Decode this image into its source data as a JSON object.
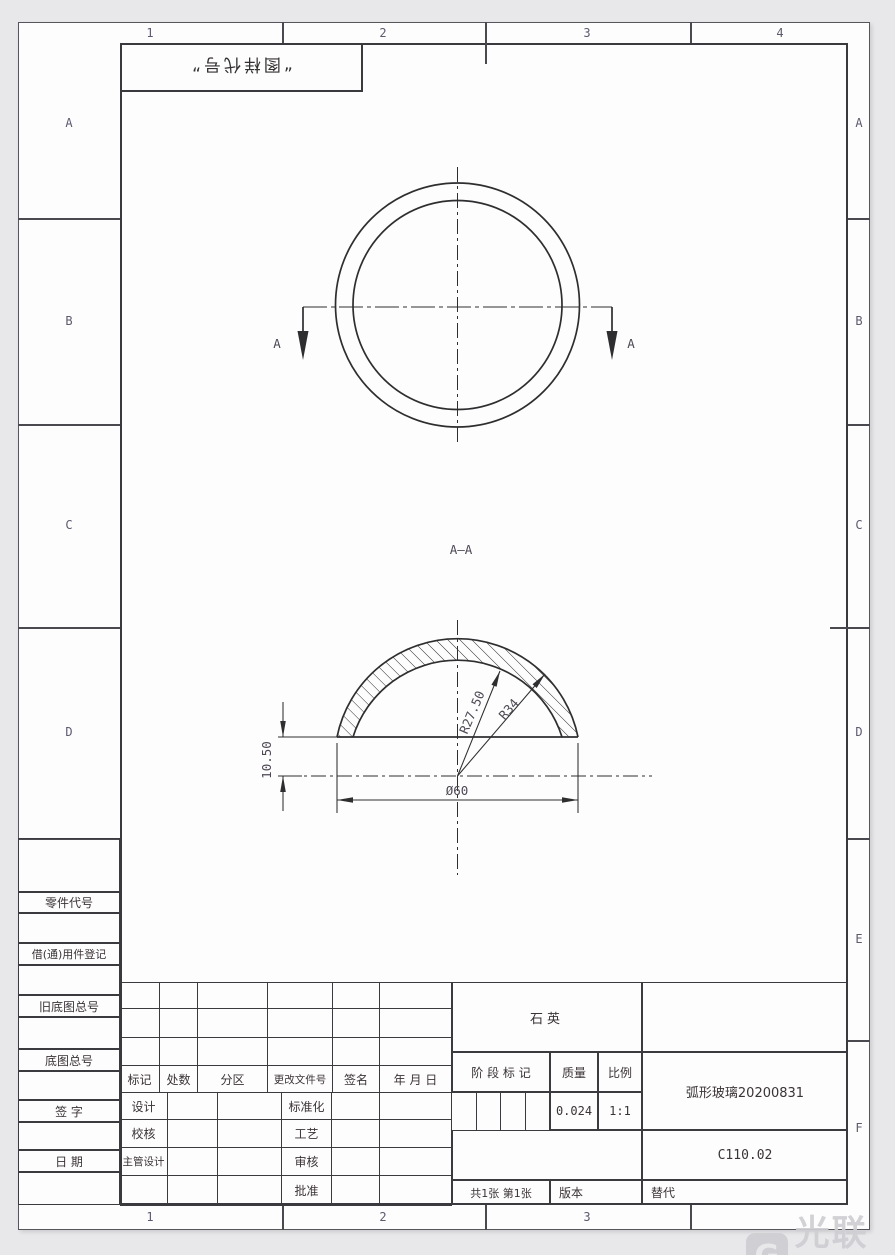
{
  "colors": {
    "line": "#2e2e30",
    "dim_text": "#4d4854",
    "zone_text": "#5c5a6e",
    "watermark": "#cfcfd3"
  },
  "zones": {
    "top": [
      "1",
      "2",
      "3",
      "4"
    ],
    "bottom": [
      "1",
      "2",
      "3",
      "4"
    ],
    "left": [
      "A",
      "B",
      "C",
      "D"
    ],
    "right": [
      "A",
      "B",
      "C",
      "D",
      "E",
      "F"
    ]
  },
  "stamp": {
    "text": "“图样代号”"
  },
  "views": {
    "section_label": "A—A",
    "cut_label": "A",
    "dims": {
      "inner_radius": "R27.50",
      "outer_radius": "R34",
      "diameter": "Ø60",
      "height": "10.50"
    }
  },
  "title_block": {
    "material": "石英",
    "part_name": "弧形玻璃20200831",
    "drawing_no": "C110.02",
    "stage_mark_label": "阶 段 标 记",
    "mass_label": "质量",
    "mass_value": "0.024",
    "scale_label": "比例",
    "scale_value": "1:1",
    "sheets_text": "共1张  第1张",
    "version_label": "版本",
    "replace_label": "替代",
    "change_header": [
      "标记",
      "处数",
      "分区",
      "更改文件号",
      "签名",
      "年 月 日"
    ],
    "sign_rows": [
      [
        "设计",
        "标准化"
      ],
      [
        "校核",
        "工艺"
      ],
      [
        "主管设计",
        "审核"
      ],
      [
        "",
        "批准"
      ]
    ],
    "left_labels": [
      "零件代号",
      "借(通)用件登记",
      "旧底图总号",
      "底图总号",
      "签 字",
      "日 期"
    ]
  },
  "watermark": {
    "text": "光联社",
    "icon_letter": "G"
  }
}
